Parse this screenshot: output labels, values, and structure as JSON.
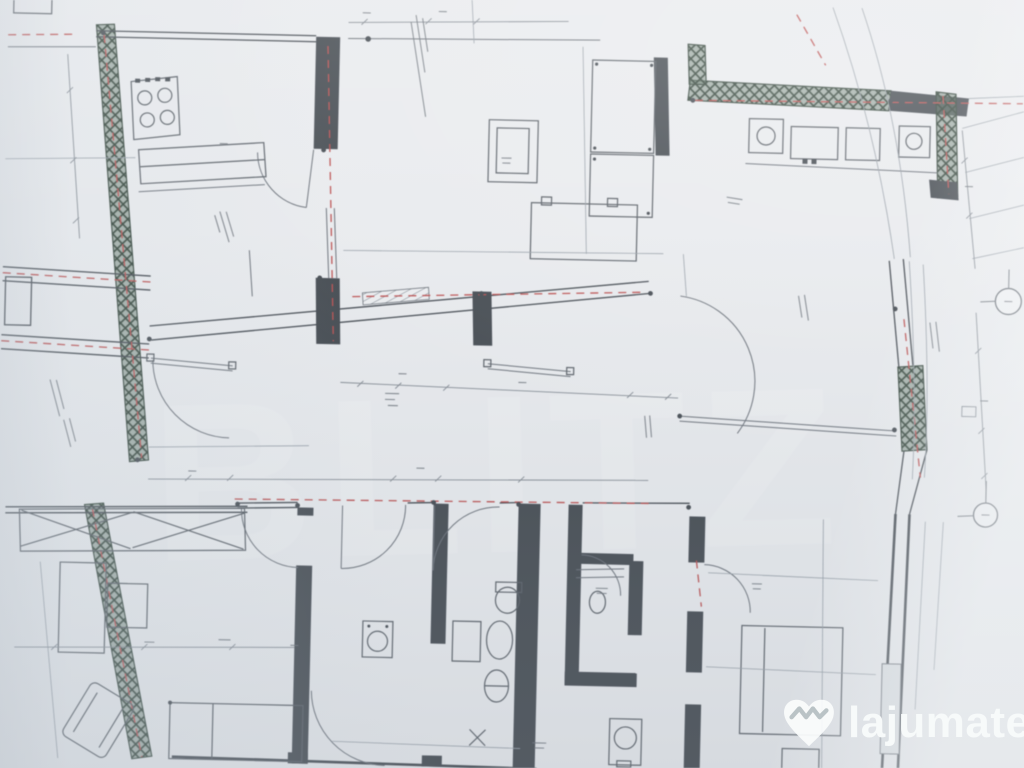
{
  "image": {
    "kind": "photo-of-architectural-floor-plan",
    "orientation": "slightly-rotated-camera-photo",
    "legible_text_note": "dimension numbers and room labels are too small and blurred to read"
  },
  "colors": {
    "paper": "#e9ebee",
    "wall": "#454b52",
    "line": "#6c727a",
    "faint": "#9aa2aa",
    "dim": "#858c94",
    "red": "#bd5252",
    "green": "#5d7464",
    "green_dark": "#35463c",
    "furn": "#5a6067",
    "brand_white": "#f7fafa",
    "brand_teal": "#3cc7c7"
  },
  "background_watermark": {
    "text": "BLITZ"
  },
  "site_watermark": {
    "brand": "lajumate",
    "tld": ".ro",
    "logo": "handshake-heart-icon"
  },
  "plan": {
    "features": {
      "exterior_walls_hatched_green": true,
      "axis_lines_red_dashed": true,
      "door_arcs": 8,
      "axis_markers_right_edge": 2,
      "dimension_lines_with_ticks": true
    },
    "fixtures": [
      "stove-4-burner",
      "kitchen-counter",
      "sink-unit-left",
      "sink-unit-right",
      "shaft-column",
      "double-wardrobe",
      "table",
      "crossed-closet",
      "wardrobe",
      "armchair",
      "bed",
      "toilet",
      "pedestal-sink",
      "bidet",
      "washing-machine",
      "boiler",
      "double-bed",
      "floor-drain",
      "rail-left",
      "rail-right"
    ]
  }
}
